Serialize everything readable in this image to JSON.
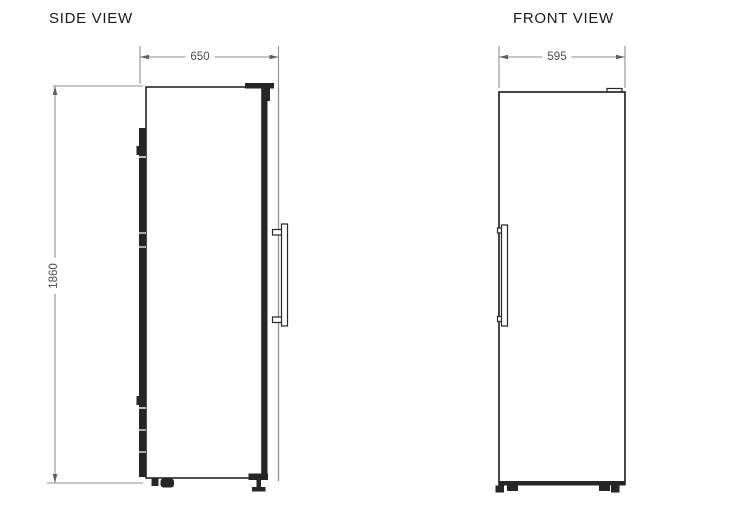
{
  "document": {
    "type": "appliance technical drawing, two orthographic views of a tall refrigerator"
  },
  "colors": {
    "line": "#262626",
    "dim_line": "#8f8f8f",
    "arrow": "#5f5f5f",
    "dim_text": "#4d4d4d",
    "title_text": "#1a1a1a",
    "background": "#ffffff"
  },
  "side_view": {
    "title": "SIDE VIEW",
    "width_mm": "650",
    "height_mm": "1860"
  },
  "front_view": {
    "title": "FRONT VIEW",
    "width_mm": "595"
  }
}
